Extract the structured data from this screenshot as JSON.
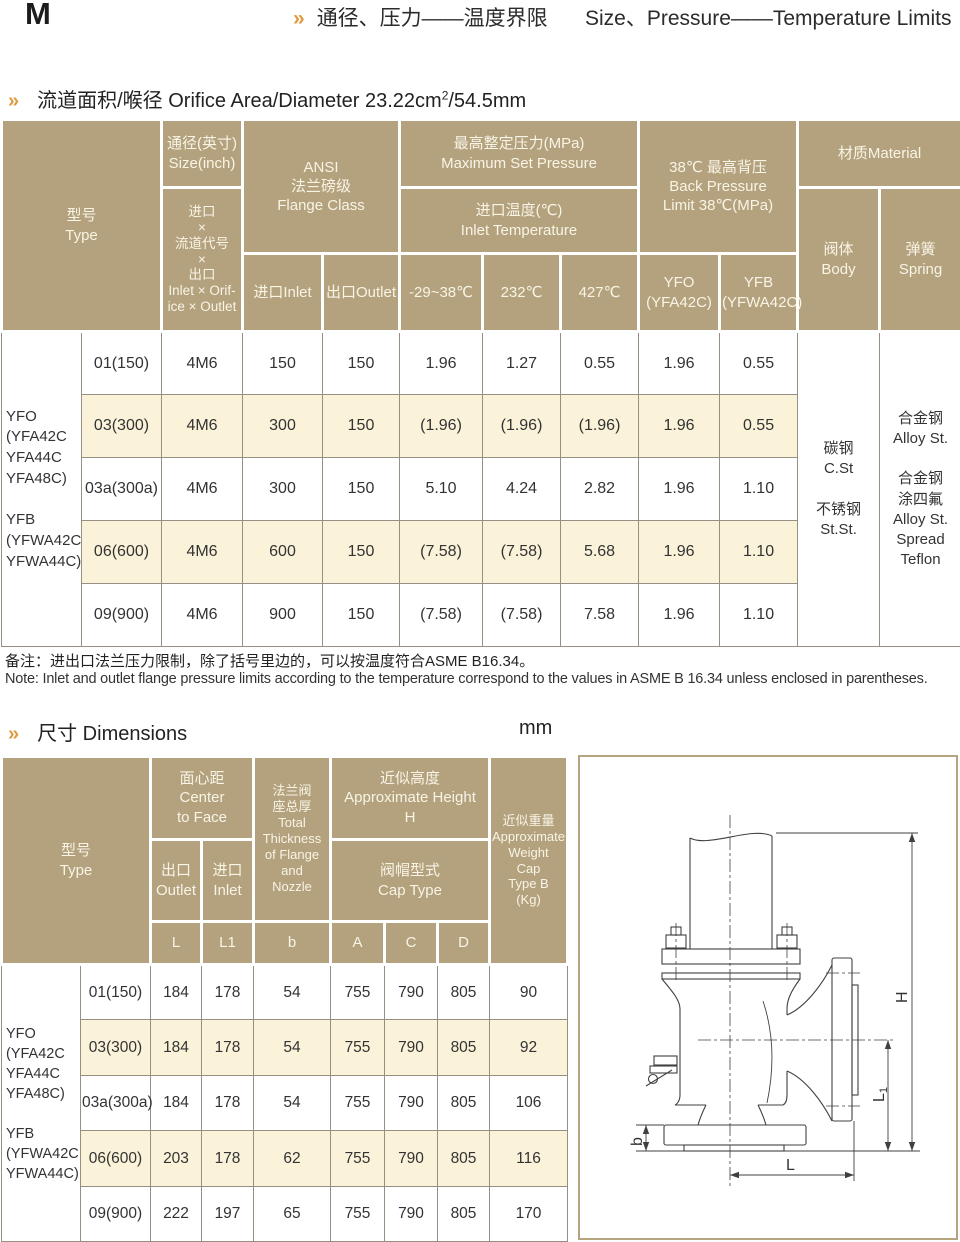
{
  "colors": {
    "header_bg": "#b3a27d",
    "row_alt": "#faf3da",
    "accent": "#e09a40",
    "frame": "#b5a47e"
  },
  "topbar": {
    "letter": "M",
    "chevron": "»",
    "title_cn": "通径、压力——温度界限",
    "title_en": "Size、Pressure——Temperature Limits"
  },
  "section1": {
    "chevron": "»",
    "title": "流道面积/喉径 Orifice Area/Diameter 23.22cm",
    "sup": "2",
    "tail": "/54.5mm"
  },
  "t1": {
    "h": {
      "type": "型号\nType",
      "size": "通径(英寸)\nSize(inch)",
      "ioo": "进口\n×\n流道代号\n×\n出口\nInlet × Orif-\nice × Outlet",
      "ansi": "ANSI\n法兰磅级\nFlange Class",
      "inlet": "进口Inlet",
      "outlet": "出口Outlet",
      "max_set": "最高整定压力(MPa)\nMaximum Set Pressure",
      "inlet_temp": "进口温度(℃)\nInlet Temperature",
      "t38": "-29~38℃",
      "t232": "232℃",
      "t427": "427℃",
      "back": "38℃ 最高背压\nBack Pressure\nLimit 38℃(MPa)",
      "yfo": "YFO\n(YFA42C)",
      "yfb": "YFB\n(YFWA42C)",
      "material": "材质Material",
      "body": "阀体\nBody",
      "spring": "弹簧\nSpring"
    },
    "series": "YFO\n(YFA42C\nYFA44C\nYFA48C)\n\nYFB\n(YFWA42C\nYFWA44C)",
    "body_mat": "碳钢\nC.St\n\n不锈钢\nSt.St.",
    "spring_mat": "合金钢\nAlloy St.\n\n合金钢\n涂四氟\nAlloy St.\nSpread\nTeflon",
    "rows": [
      [
        "01(150)",
        "4M6",
        "150",
        "150",
        "1.96",
        "1.27",
        "0.55",
        "1.96",
        "0.55"
      ],
      [
        "03(300)",
        "4M6",
        "300",
        "150",
        "(1.96)",
        "(1.96)",
        "(1.96)",
        "1.96",
        "0.55"
      ],
      [
        "03a(300a)",
        "4M6",
        "300",
        "150",
        "5.10",
        "4.24",
        "2.82",
        "1.96",
        "1.10"
      ],
      [
        "06(600)",
        "4M6",
        "600",
        "150",
        "(7.58)",
        "(7.58)",
        "5.68",
        "1.96",
        "1.10"
      ],
      [
        "09(900)",
        "4M6",
        "900",
        "150",
        "(7.58)",
        "(7.58)",
        "7.58",
        "1.96",
        "1.10"
      ]
    ]
  },
  "notes": {
    "cn": "备注：进出口法兰压力限制，除了括号里边的，可以按温度符合ASME B16.34。",
    "en": "Note:  Inlet and outlet flange pressure limits according to the temperature correspond to the  values in ASME B 16.34 unless enclosed in parentheses."
  },
  "section2": {
    "chevron": "»",
    "title": "尺寸 Dimensions",
    "unit": "mm"
  },
  "t2": {
    "h": {
      "type": "型号\nType",
      "center": "面心距\nCenter\nto  Face",
      "outlet": "出口\nOutlet",
      "inlet": "进口\nInlet",
      "thickness": "法兰阀\n座总厚\nTotal\nThickness\nof Flange\nand\nNozzle",
      "height": "近似高度\nApproximate  Height\nH",
      "cap": "阀帽型式\nCap Type",
      "weight": "近似重量\nApproximate\nWeight\nCap\nType B\n(Kg)",
      "letters": [
        "L",
        "L1",
        "b",
        "A",
        "C",
        "D"
      ]
    },
    "series": "YFO\n(YFA42C\nYFA44C\nYFA48C)\n\nYFB\n(YFWA42C\nYFWA44C)",
    "rows": [
      [
        "01(150)",
        "184",
        "178",
        "54",
        "755",
        "790",
        "805",
        "90"
      ],
      [
        "03(300)",
        "184",
        "178",
        "54",
        "755",
        "790",
        "805",
        "92"
      ],
      [
        "03a(300a)",
        "184",
        "178",
        "54",
        "755",
        "790",
        "805",
        "106"
      ],
      [
        "06(600)",
        "203",
        "178",
        "62",
        "755",
        "790",
        "805",
        "116"
      ],
      [
        "09(900)",
        "222",
        "197",
        "65",
        "755",
        "790",
        "805",
        "170"
      ]
    ]
  },
  "diagram": {
    "labels": {
      "h": "H",
      "l1_main": "L",
      "l1_sub": "1",
      "b": "b",
      "l": "L"
    }
  }
}
